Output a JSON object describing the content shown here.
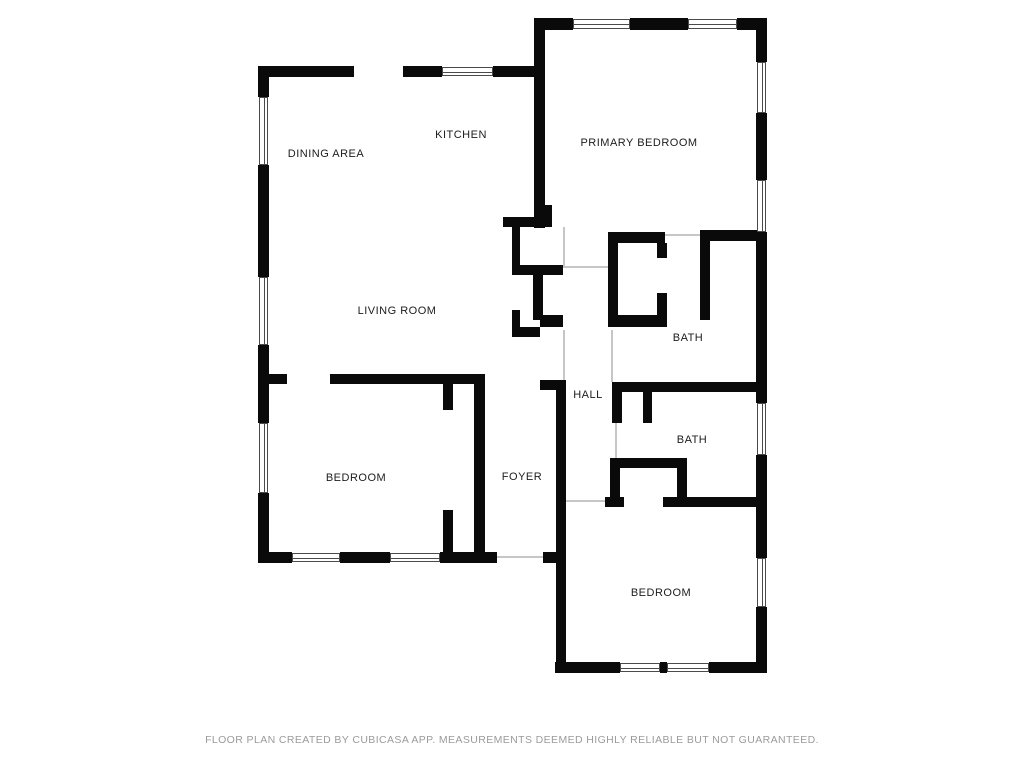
{
  "meta": {
    "type": "floor-plan",
    "creator_note": "CubiCasa floor plan"
  },
  "colors": {
    "background": "#ffffff",
    "wall": "#0a0a0a",
    "window_frame": "#4a4a4a",
    "opening_line": "#c6c6c6",
    "label": "#1c1c1c",
    "footer": "#9b9b9b"
  },
  "footer": {
    "disclaimer": "FLOOR PLAN CREATED BY CUBICASA APP. MEASUREMENTS DEEMED HIGHLY RELIABLE BUT NOT GUARANTEED."
  },
  "rooms": [
    {
      "id": "dining-area",
      "label": "DINING AREA",
      "x": 326,
      "y": 154
    },
    {
      "id": "kitchen",
      "label": "KITCHEN",
      "x": 461,
      "y": 135
    },
    {
      "id": "primary-bedroom",
      "label": "PRIMARY BEDROOM",
      "x": 639,
      "y": 143
    },
    {
      "id": "living-room",
      "label": "LIVING ROOM",
      "x": 397,
      "y": 311
    },
    {
      "id": "bath-upper",
      "label": "BATH",
      "x": 688,
      "y": 338
    },
    {
      "id": "hall",
      "label": "HALL",
      "x": 588,
      "y": 395
    },
    {
      "id": "bath-lower",
      "label": "BATH",
      "x": 692,
      "y": 440
    },
    {
      "id": "foyer",
      "label": "FOYER",
      "x": 522,
      "y": 477
    },
    {
      "id": "bedroom-left",
      "label": "BEDROOM",
      "x": 356,
      "y": 478
    },
    {
      "id": "bedroom-right",
      "label": "BEDROOM",
      "x": 661,
      "y": 593
    }
  ],
  "floorplan": {
    "walls": [
      [
        258,
        66,
        96,
        11
      ],
      [
        403,
        66,
        39,
        11
      ],
      [
        493,
        66,
        52,
        11
      ],
      [
        535,
        18,
        38,
        12
      ],
      [
        630,
        18,
        58,
        12
      ],
      [
        737,
        18,
        30,
        12
      ],
      [
        258,
        66,
        11,
        31
      ],
      [
        258,
        165,
        11,
        112
      ],
      [
        258,
        345,
        11,
        78
      ],
      [
        258,
        493,
        11,
        70
      ],
      [
        756,
        18,
        11,
        44
      ],
      [
        756,
        113,
        11,
        67
      ],
      [
        756,
        232,
        11,
        171
      ],
      [
        756,
        455,
        11,
        103
      ],
      [
        756,
        607,
        11,
        66
      ],
      [
        258,
        552,
        34,
        11
      ],
      [
        340,
        552,
        50,
        11
      ],
      [
        440,
        552,
        57,
        11
      ],
      [
        543,
        552,
        23,
        11
      ],
      [
        555,
        662,
        65,
        11
      ],
      [
        660,
        662,
        7,
        11
      ],
      [
        709,
        662,
        58,
        11
      ],
      [
        556,
        390,
        10,
        283
      ],
      [
        540,
        380,
        26,
        10
      ],
      [
        534,
        18,
        11,
        210
      ],
      [
        503,
        217,
        49,
        10
      ],
      [
        543,
        205,
        9,
        12
      ],
      [
        512,
        217,
        8,
        58
      ],
      [
        512,
        265,
        51,
        10
      ],
      [
        533,
        275,
        10,
        45
      ],
      [
        540,
        315,
        23,
        12
      ],
      [
        512,
        310,
        8,
        27
      ],
      [
        512,
        327,
        28,
        10
      ],
      [
        258,
        374,
        29,
        10
      ],
      [
        330,
        374,
        153,
        10
      ],
      [
        474,
        374,
        11,
        189
      ],
      [
        443,
        384,
        10,
        26
      ],
      [
        443,
        510,
        10,
        53
      ],
      [
        605,
        497,
        19,
        10
      ],
      [
        663,
        497,
        96,
        10
      ],
      [
        610,
        458,
        77,
        10
      ],
      [
        610,
        468,
        10,
        39
      ],
      [
        677,
        468,
        10,
        34
      ],
      [
        612,
        382,
        148,
        10
      ],
      [
        612,
        392,
        10,
        31
      ],
      [
        643,
        392,
        9,
        31
      ],
      [
        608,
        232,
        10,
        95
      ],
      [
        608,
        232,
        57,
        11
      ],
      [
        657,
        243,
        10,
        15
      ],
      [
        657,
        293,
        10,
        34
      ],
      [
        608,
        315,
        59,
        12
      ],
      [
        700,
        230,
        10,
        90
      ],
      [
        700,
        230,
        58,
        11
      ]
    ],
    "windows": [
      {
        "x": 259,
        "y": 97,
        "w": 9,
        "h": 68,
        "o": "v"
      },
      {
        "x": 259,
        "y": 277,
        "w": 9,
        "h": 68,
        "o": "v"
      },
      {
        "x": 259,
        "y": 423,
        "w": 9,
        "h": 70,
        "o": "v"
      },
      {
        "x": 442,
        "y": 67,
        "w": 51,
        "h": 9,
        "o": "h"
      },
      {
        "x": 573,
        "y": 19,
        "w": 57,
        "h": 10,
        "o": "h"
      },
      {
        "x": 688,
        "y": 19,
        "w": 49,
        "h": 10,
        "o": "h"
      },
      {
        "x": 757,
        "y": 62,
        "w": 9,
        "h": 51,
        "o": "v"
      },
      {
        "x": 757,
        "y": 180,
        "w": 9,
        "h": 52,
        "o": "v"
      },
      {
        "x": 757,
        "y": 403,
        "w": 9,
        "h": 52,
        "o": "v"
      },
      {
        "x": 757,
        "y": 558,
        "w": 9,
        "h": 49,
        "o": "v"
      },
      {
        "x": 292,
        "y": 553,
        "w": 48,
        "h": 9,
        "o": "h"
      },
      {
        "x": 390,
        "y": 553,
        "w": 50,
        "h": 9,
        "o": "h"
      },
      {
        "x": 620,
        "y": 663,
        "w": 40,
        "h": 9,
        "o": "h"
      },
      {
        "x": 667,
        "y": 663,
        "w": 42,
        "h": 9,
        "o": "h"
      }
    ],
    "openings": [
      [
        497,
        556,
        46,
        2
      ],
      [
        566,
        500,
        39,
        2
      ],
      [
        563,
        266,
        45,
        2
      ],
      [
        665,
        234,
        35,
        2
      ],
      [
        563,
        227,
        2,
        40
      ],
      [
        563,
        330,
        2,
        52
      ],
      [
        611,
        330,
        2,
        52
      ],
      [
        615,
        423,
        2,
        35
      ]
    ]
  }
}
